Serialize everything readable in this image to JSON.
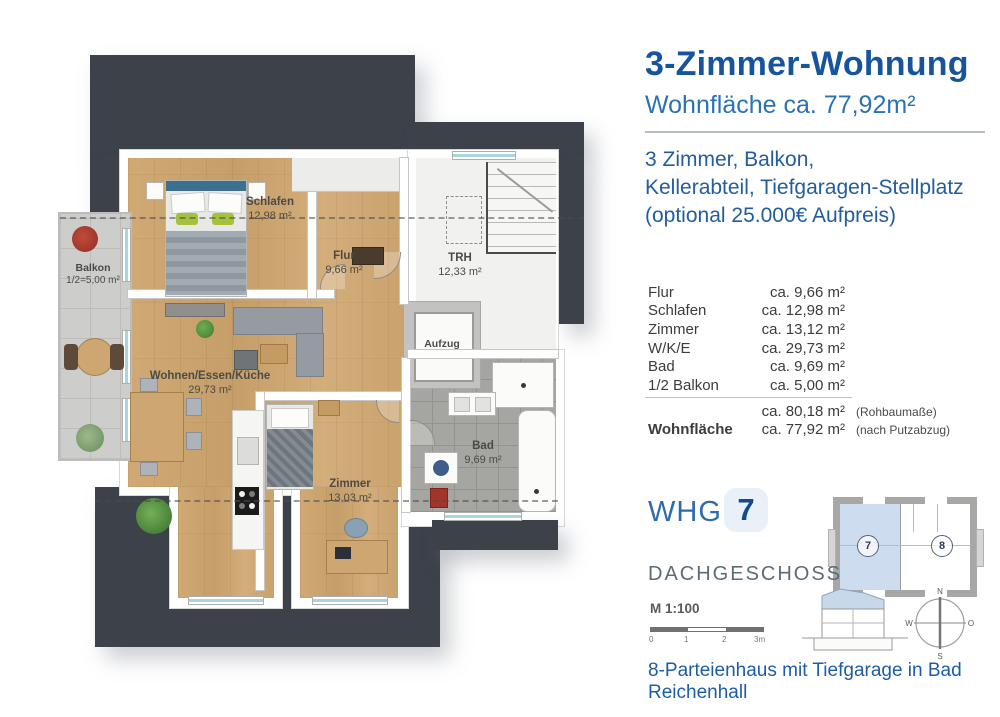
{
  "panel": {
    "title": "3-Zimmer-Wohnung",
    "subtitle": "Wohnfläche ca. 77,92m²",
    "description": [
      "3 Zimmer, Balkon,",
      "Kellerabteil, Tiefgaragen-Stellplatz",
      "(optional 25.000€ Aufpreis)"
    ],
    "room_table": {
      "rows": [
        {
          "label": "Flur",
          "value": "ca. 9,66 m²"
        },
        {
          "label": "Schlafen",
          "value": "ca. 12,98 m²"
        },
        {
          "label": "Zimmer",
          "value": "ca. 13,12 m²"
        },
        {
          "label": "W/K/E",
          "value": "ca. 29,73 m²"
        },
        {
          "label": "Bad",
          "value": "ca. 9,69 m²"
        },
        {
          "label": "1/2 Balkon",
          "value": "ca. 5,00 m²"
        }
      ],
      "subtotal": {
        "value": "ca. 80,18 m²",
        "note": "(Rohbaumaße)"
      },
      "total": {
        "label": "Wohnfläche",
        "value": "ca. 77,92 m²",
        "note": "(nach Putzabzug)"
      }
    },
    "unit": {
      "label": "WHG",
      "number": "7"
    },
    "floor_name": "DACHGESCHOSS",
    "key_plan": {
      "unit_left": "7",
      "unit_right": "8"
    },
    "scale": {
      "label": "M 1:100",
      "ticks": [
        "0",
        "1",
        "2",
        "3m"
      ]
    },
    "compass": {
      "n": "N",
      "e": "O",
      "s": "S",
      "w": "W"
    },
    "footer": "8-Parteienhaus mit Tiefgarage in Bad Reichenhall",
    "colors": {
      "accent_blue": "#17549e",
      "light_blue": "#2b72b4",
      "roof_dark": "#3d414a",
      "key_plan_blue": "#cddcee"
    }
  },
  "floorplan": {
    "rooms": [
      {
        "name": "Schlafen",
        "area": "12,98 m²"
      },
      {
        "name": "Flur",
        "area": "9,66 m²"
      },
      {
        "name": "TRH",
        "area": "12,33 m²"
      },
      {
        "name": "Aufzug",
        "area": ""
      },
      {
        "name": "Wohnen/Essen/Küche",
        "area": "29,73 m²"
      },
      {
        "name": "Zimmer",
        "area": "13,03 m²"
      },
      {
        "name": "Bad",
        "area": "9,69 m²"
      },
      {
        "name": "Balkon",
        "area": "1/2=5,00 m²"
      }
    ]
  }
}
